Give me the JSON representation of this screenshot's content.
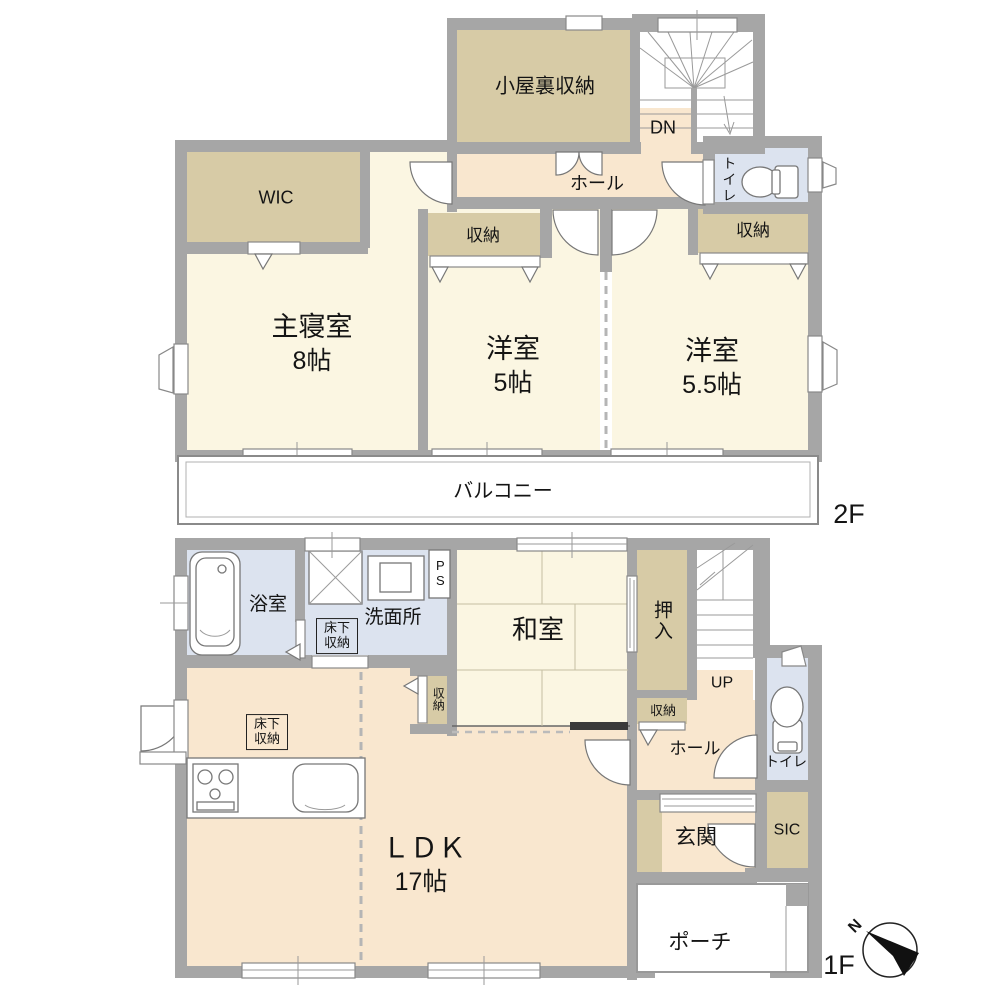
{
  "floor2": {
    "label": "2F",
    "attic": "小屋裏収納",
    "dn": "DN",
    "hall": "ホール",
    "toilet": "トイレ",
    "wic": "WIC",
    "master": {
      "name": "主寝室",
      "size": "8帖"
    },
    "closet1": "収納",
    "western1": {
      "name": "洋室",
      "size": "5帖"
    },
    "closet2": "収納",
    "western2": {
      "name": "洋室",
      "size": "5.5帖"
    },
    "balcony": "バルコニー"
  },
  "floor1": {
    "label": "1F",
    "bath": "浴室",
    "washroom": "洗面所",
    "ps": "PS",
    "underfloor_wash": "床下収納",
    "underfloor_kitchen": "床下収納",
    "washitsu": "和室",
    "oshiire": "押入",
    "up": "UP",
    "closet_west": "収納",
    "closet_hall": "収納",
    "hall": "ホール",
    "toilet": "トイレ",
    "ldk": {
      "name": "ＬＤＫ",
      "size": "17帖"
    },
    "genkan": "玄関",
    "sic": "SIC",
    "porch": "ポーチ"
  },
  "compass": {
    "north": "N"
  },
  "colors": {
    "wall": "#a6a6a6",
    "room_cream": "#fbf6e2",
    "storage_tan": "#d7cba6",
    "hall_peach": "#f9e7cf",
    "wet_blue": "#dce3ef",
    "accent_dark": "#141414"
  }
}
